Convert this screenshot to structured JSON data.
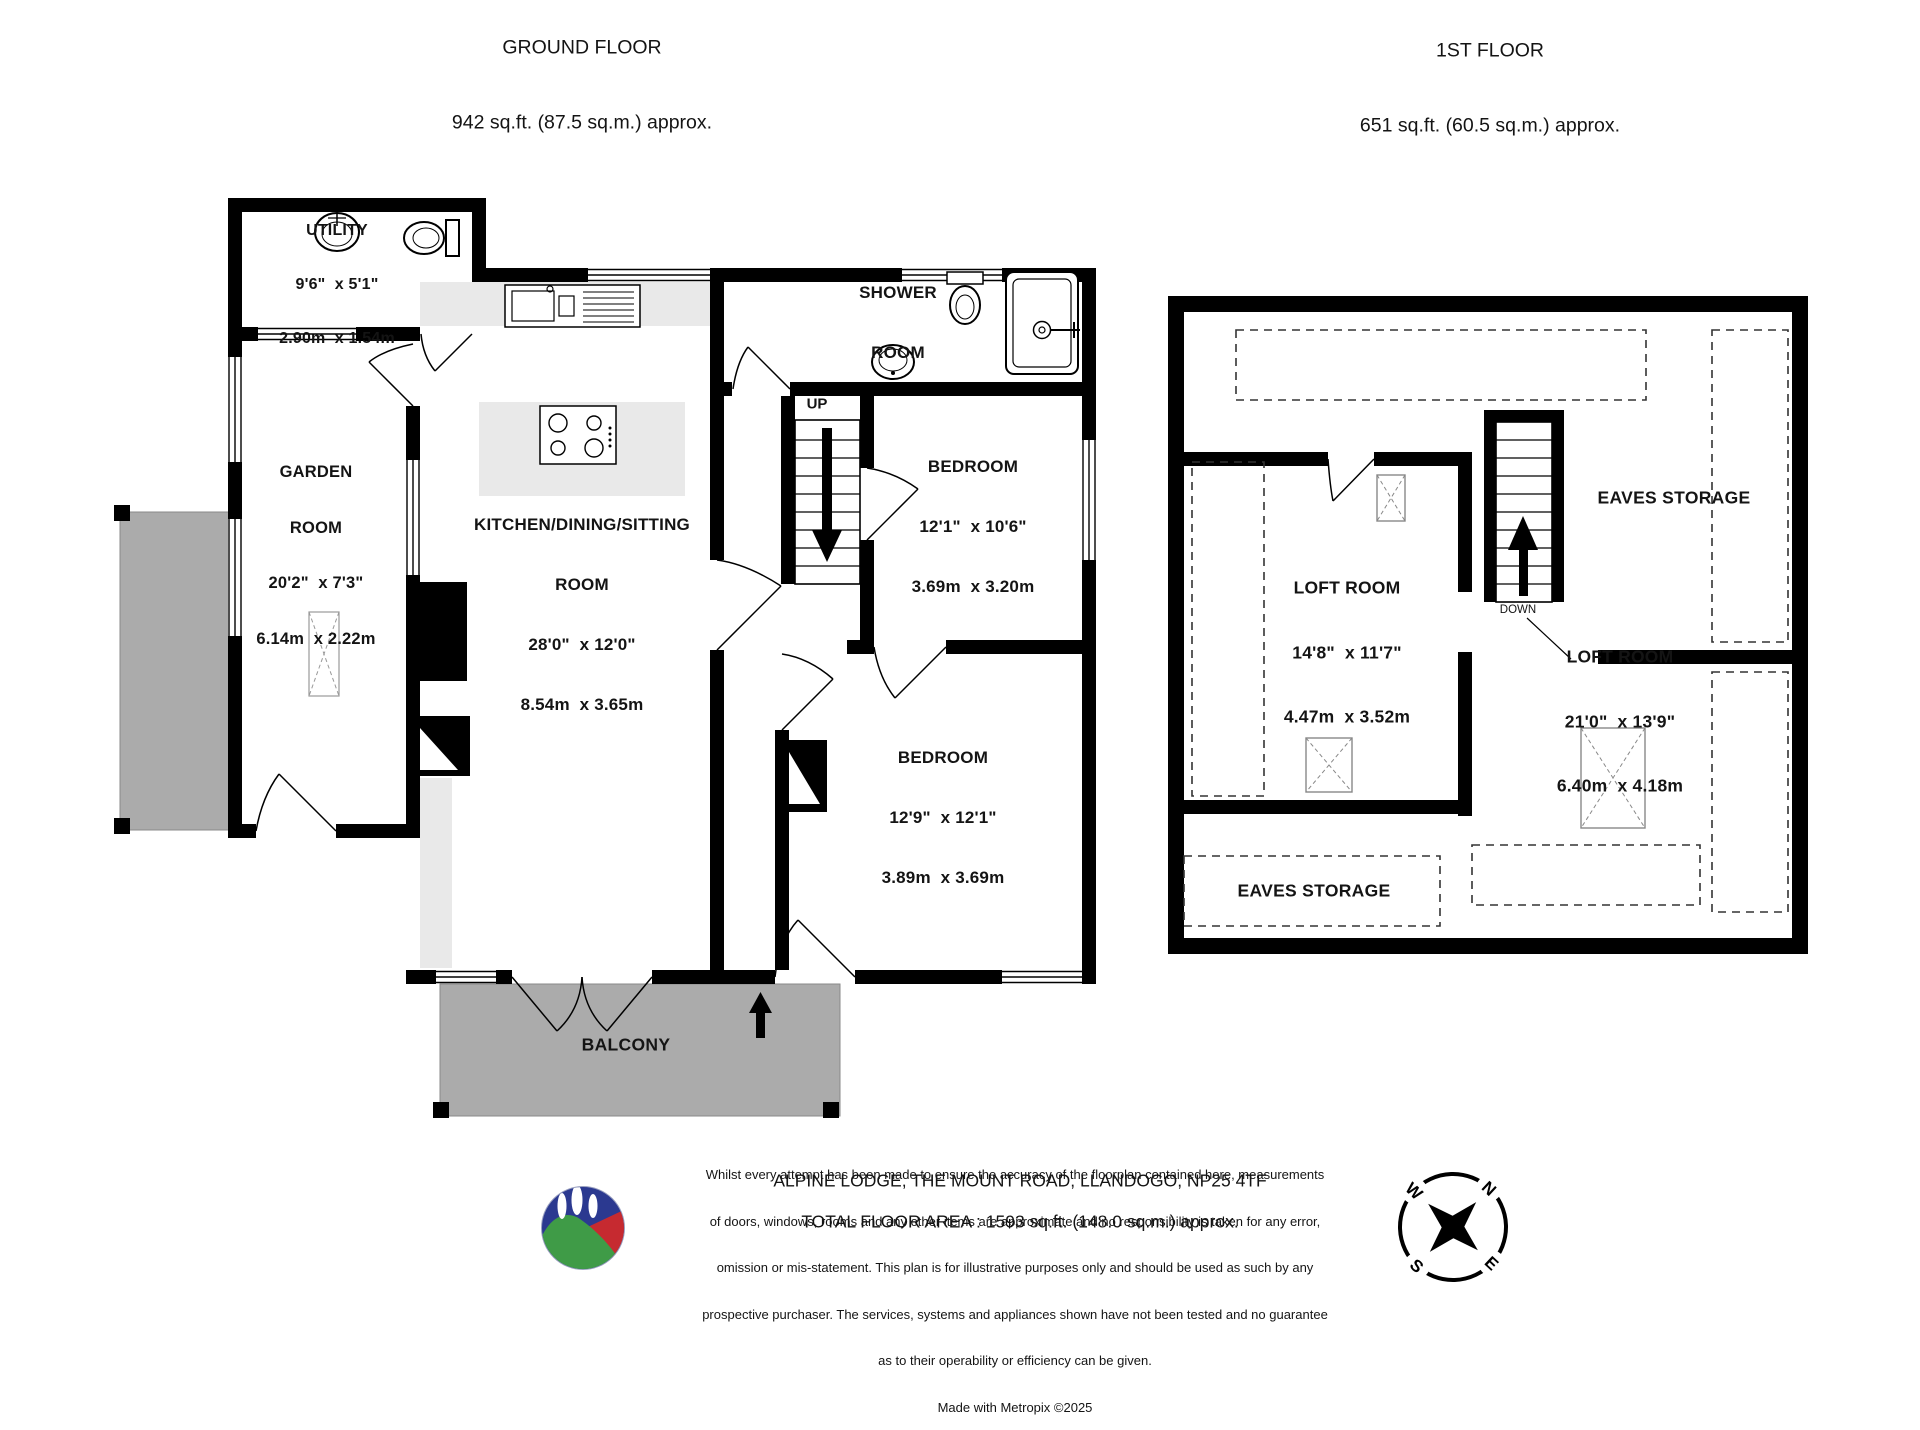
{
  "ground_floor": {
    "title": "GROUND FLOOR",
    "area": "942 sq.ft. (87.5 sq.m.) approx.",
    "stairs_label": "UP",
    "rooms": {
      "utility": {
        "name": "UTILITY",
        "imperial": "9'6\"  x 5'1\"",
        "metric": "2.90m  x 1.54m"
      },
      "garden": {
        "line1": "GARDEN",
        "line2": "ROOM",
        "imperial": "20'2\"  x 7'3\"",
        "metric": "6.14m  x 2.22m"
      },
      "kitchen": {
        "line1": "KITCHEN/DINING/SITTING",
        "line2": "ROOM",
        "imperial": "28'0\"  x 12'0\"",
        "metric": "8.54m  x 3.65m"
      },
      "shower": {
        "line1": "SHOWER",
        "line2": "ROOM"
      },
      "bedroom1": {
        "name": "BEDROOM",
        "imperial": "12'1\"  x 10'6\"",
        "metric": "3.69m  x 3.20m"
      },
      "bedroom2": {
        "name": "BEDROOM",
        "imperial": "12'9\"  x 12'1\"",
        "metric": "3.89m  x 3.69m"
      },
      "balcony": "BALCONY"
    }
  },
  "first_floor": {
    "title": "1ST FLOOR",
    "area": "651 sq.ft. (60.5 sq.m.) approx.",
    "stairs_label": "DOWN",
    "rooms": {
      "loft1": {
        "name": "LOFT ROOM",
        "imperial": "14'8\"  x 11'7\"",
        "metric": "4.47m  x 3.52m"
      },
      "loft2": {
        "name": "LOFT ROOM",
        "imperial": "21'0\"  x 13'9\"",
        "metric": "6.40m  x 4.18m"
      },
      "eaves_right": "EAVES STORAGE",
      "eaves_bottom": "EAVES STORAGE"
    }
  },
  "footer": {
    "address": "ALPINE LODGE, THE MOUNT ROAD, LLANDOGO, NP25 4TF",
    "total_area": "TOTAL FLOOR AREA : 1593 sq.ft. (148.0 sq.m.) approx.",
    "disclaimer_lines": [
      "Whilst every attempt has been made to ensure the accuracy of the floorplan contained here, measurements",
      "of doors, windows, rooms and any other items are approximate and no responsibility is taken for any error,",
      "omission or mis-statement. This plan is for illustrative purposes only and should be used as such by any",
      "prospective purchaser. The services, systems and appliances shown have not been tested and no guarantee",
      "as to their operability or efficiency can be given."
    ],
    "credit": "Made with Metropix ©2025"
  },
  "compass": {
    "n": "N",
    "e": "E",
    "s": "S",
    "w": "W"
  },
  "colors": {
    "wall": "#000000",
    "outdoor_gray": "#ababab",
    "fitting_gray": "#e9e9e9",
    "logo_blue": "#2b3990",
    "logo_green": "#3f9b47",
    "logo_red": "#c62a30"
  }
}
